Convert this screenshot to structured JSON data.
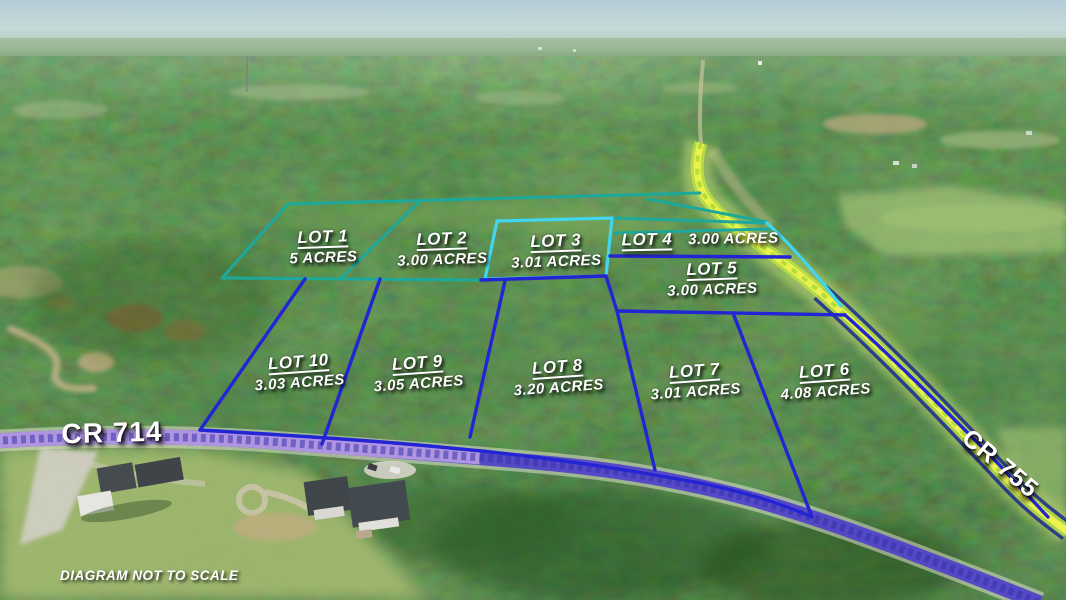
{
  "map": {
    "lots": [
      {
        "name": "LOT 1",
        "acres": "5 ACRES"
      },
      {
        "name": "LOT 2",
        "acres": "3.00 ACRES"
      },
      {
        "name": "LOT 3",
        "acres": "3.01 ACRES"
      },
      {
        "name": "LOT 4",
        "acres": "3.00 ACRES"
      },
      {
        "name": "LOT 5",
        "acres": "3.00 ACRES"
      },
      {
        "name": "LOT 6",
        "acres": "4.08 ACRES"
      },
      {
        "name": "LOT 7",
        "acres": "3.01 ACRES"
      },
      {
        "name": "LOT 8",
        "acres": "3.20 ACRES"
      },
      {
        "name": "LOT 9",
        "acres": "3.05 ACRES"
      },
      {
        "name": "LOT 10",
        "acres": "3.03 ACRES"
      }
    ],
    "roads": {
      "cr714": {
        "label": "CR 714"
      },
      "cr755": {
        "label": "CR 755"
      }
    },
    "disclaimer": "DIAGRAM NOT TO SCALE",
    "colors": {
      "boundary_teal": "#1ca99c",
      "boundary_cyan": "#40d6ee",
      "boundary_blue": "#2324d4",
      "road_755_highlight": "#eef34f",
      "road_755_lime": "#b8e046",
      "road_755_edge_navy": "#1c2a8e",
      "road_714_purple": "#b49ae2",
      "road_714_indigo": "#5143c8",
      "label_white": "#ffffff"
    }
  }
}
